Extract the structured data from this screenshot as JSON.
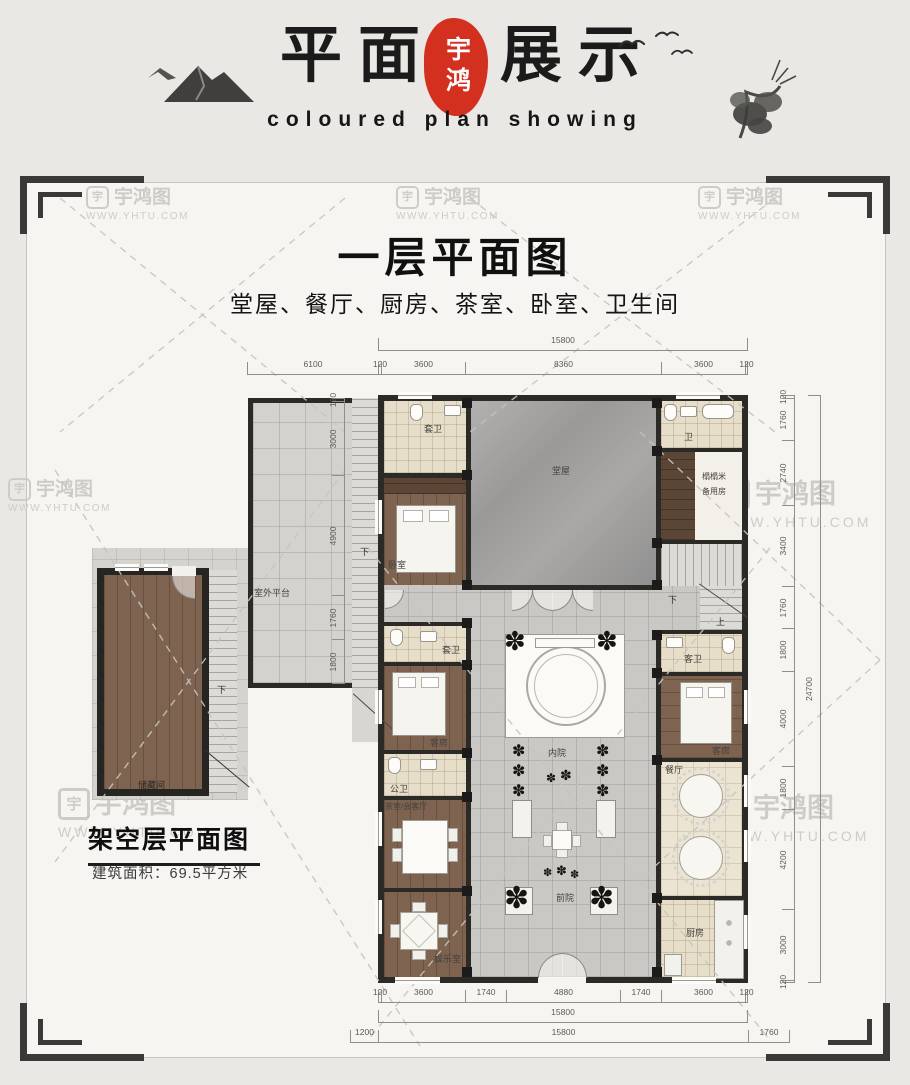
{
  "header": {
    "title_left": "平面",
    "title_right": "展示",
    "seal": "宇鸿",
    "subtitle": "coloured plan showing"
  },
  "watermark": {
    "brand": "宇鸿图",
    "url": "WWW.YHTU.COM",
    "logo_char": "宇"
  },
  "main_plan": {
    "title": "一层平面图",
    "subtitle": "堂屋、餐厅、厨房、茶室、卧室、卫生间",
    "rooms": {
      "terrace": "室外平台",
      "main_hall": "堂屋",
      "ensuite_bath_1": "套卫",
      "bedroom_1": "卧室",
      "bath_small": "卫",
      "tatami_line1": "榻榻米",
      "tatami_line2": "备用房",
      "ensuite_bath_2": "套卫",
      "guest_room_left": "客房",
      "public_bath": "公卫",
      "tea_room": "茶室/会客厅",
      "game_room": "娱乐室",
      "inner_court": "内院",
      "front_court": "前院",
      "guest_bath": "客卫",
      "guest_room_right": "客房",
      "dining": "餐厅",
      "kitchen": "厨房"
    },
    "stair_down": "下",
    "stair_up": "上",
    "dims": {
      "top_overall": "15800",
      "top": [
        "6100",
        "120",
        "3600",
        "8360",
        "3600",
        "120"
      ],
      "left": [
        "120",
        "3000",
        "4900",
        "1760",
        "1800"
      ],
      "right": [
        "120",
        "1760",
        "2740",
        "3400",
        "1760",
        "1800",
        "4000",
        "1800",
        "4200",
        "3000",
        "120"
      ],
      "right_overall": "24700",
      "bottom": [
        "120",
        "3600",
        "1740",
        "4880",
        "1740",
        "3600",
        "120"
      ],
      "bottom_overall": "15800",
      "bottom_row": [
        "1200",
        "15800",
        "1760"
      ]
    }
  },
  "small_plan": {
    "title": "架空层平面图",
    "area": "建筑面积：69.5平方米",
    "room": "储藏间",
    "stair_down": "下"
  }
}
